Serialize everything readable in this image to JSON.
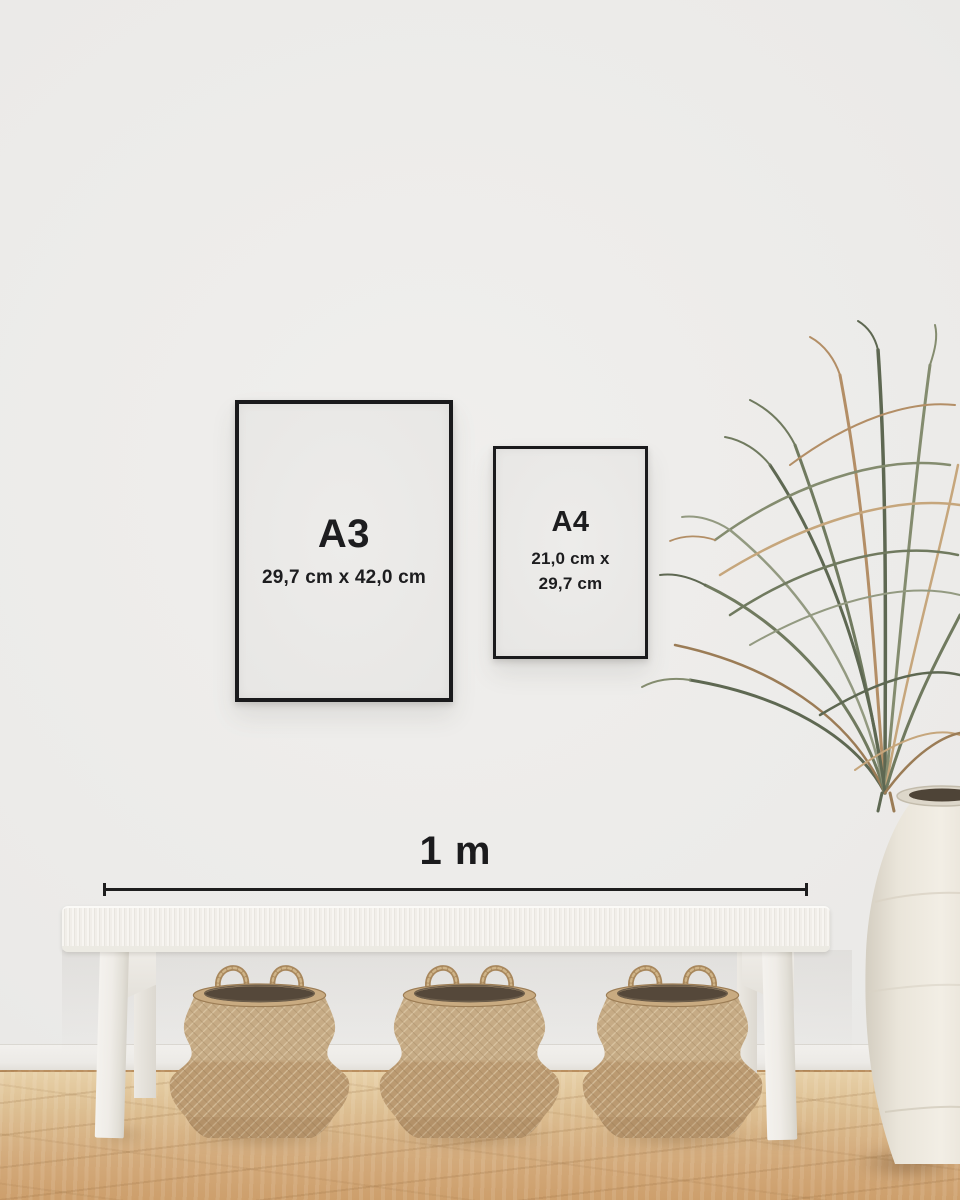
{
  "frames": [
    {
      "label": "A3",
      "dimensions": "29,7 cm x 42,0 cm"
    },
    {
      "label": "A4",
      "dimensions": "21,0 cm x\n29,7 cm"
    }
  ],
  "scale_bar": {
    "label": "1 m"
  },
  "colors": {
    "wall": "#ebeae8",
    "frame_black": "#1a1a1c",
    "paper_white": "#e9e8e6",
    "text_black": "#1d1d1f",
    "measure_line": "#1e1e1e",
    "bench_white": "#f3f1ec",
    "basket_tan": "#c2a47c",
    "basket_opening_dark": "#55483a",
    "floor_oak": "#d6ae7e",
    "vase_cream": "#ece7dd",
    "plant_green": "#6a7458",
    "plant_tan": "#b08a5f"
  }
}
